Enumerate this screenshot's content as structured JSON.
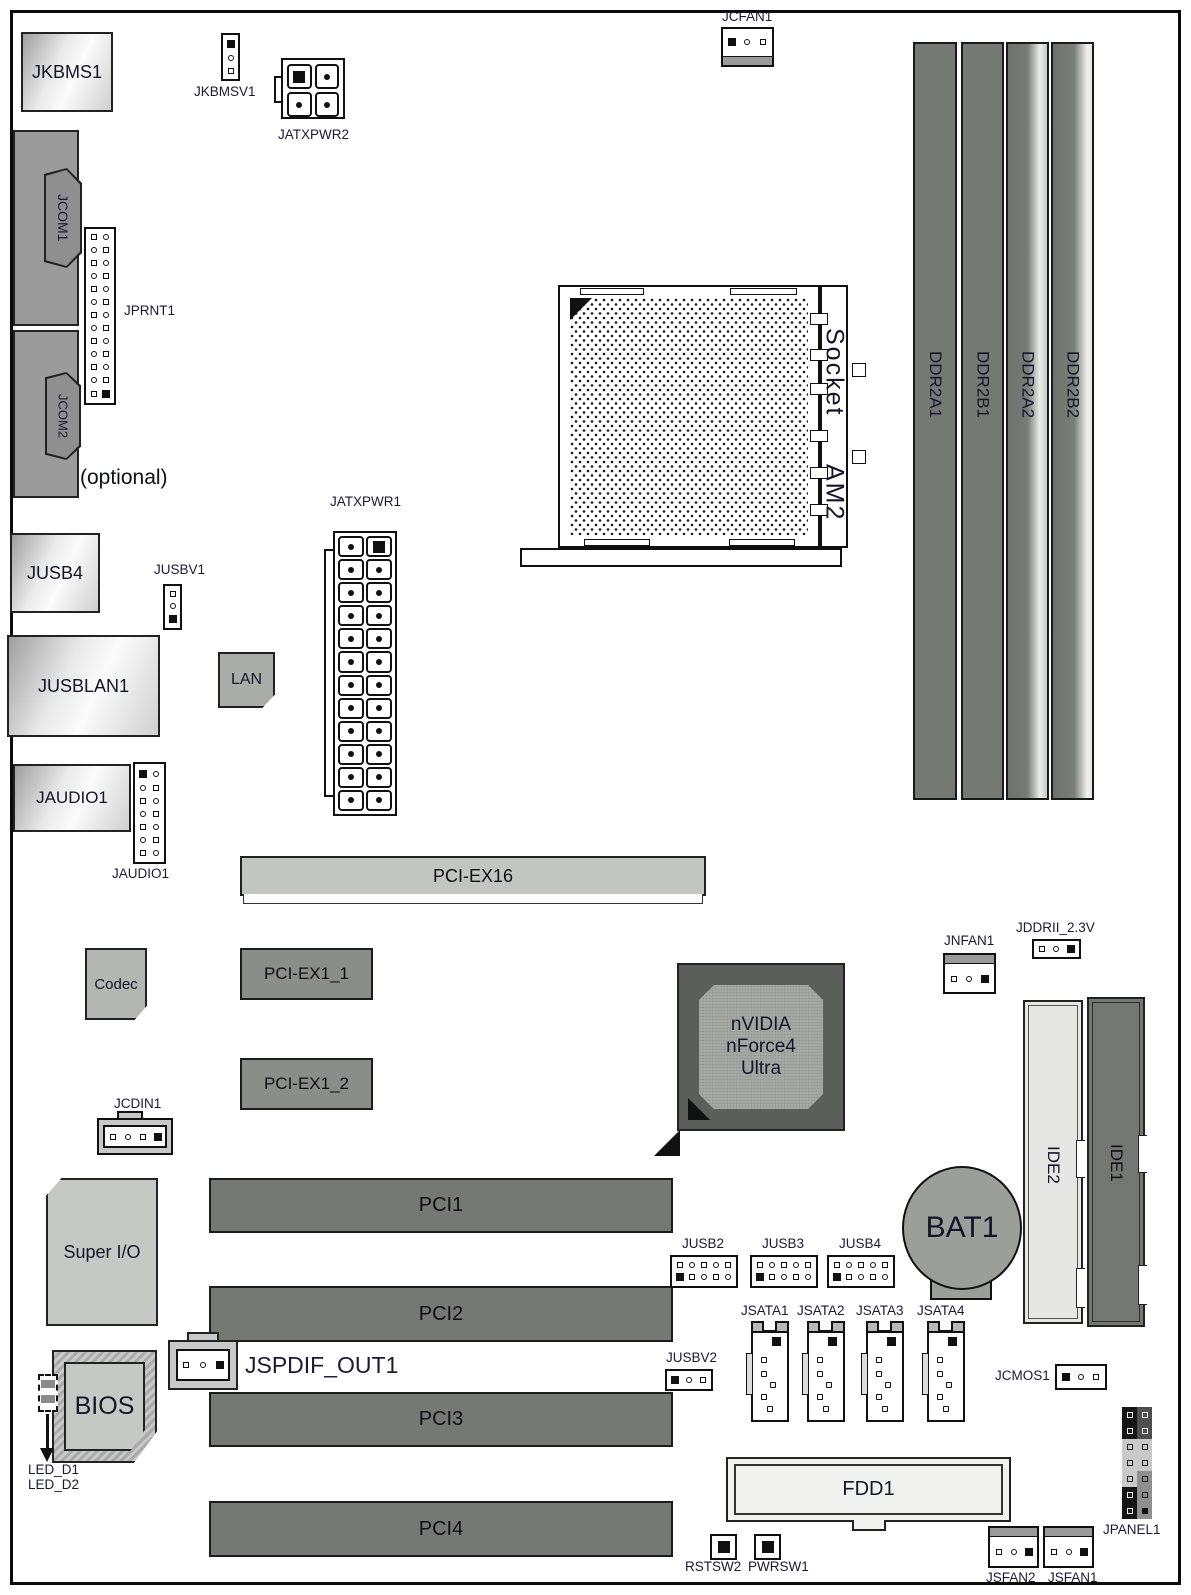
{
  "palette": {
    "outline": "#111111",
    "slot_dark": "#767973",
    "slot_mid": "#8a8d88",
    "slot_light": "#c2c5c0",
    "chip_dark": "#5b5e59",
    "chip_inner": "#a6a9a4",
    "ide_light": "#e6e6e4",
    "label_text": "#1a1a33"
  },
  "connectors": {
    "jkbms1": "JKBMS1",
    "jkbmsv1": "JKBMSV1",
    "jatxpwr2": "JATXPWR2",
    "jcfan1": "JCFAN1",
    "jcom1": "JCOM1",
    "jprnt1": "JPRNT1",
    "jcom2": "JCOM2",
    "optional": "(optional)",
    "jusb4_port": "JUSB4",
    "jusbv1": "JUSBV1",
    "jusblan1": "JUSBLAN1",
    "lan": "LAN",
    "jatxpwr1": "JATXPWR1",
    "jaudio1_port": "JAUDIO1",
    "jaudio1_header": "JAUDIO1",
    "socket_line1": "Socket",
    "socket_line2": "AM2",
    "ddr": [
      "DDR2A1",
      "DDR2B1",
      "DDR2A2",
      "DDR2B2"
    ],
    "pciex16": "PCI-EX16",
    "codec": "Codec",
    "pciex1_1": "PCI-EX1_1",
    "pciex1_2": "PCI-EX1_2",
    "jcdin1": "JCDIN1",
    "superio": "Super I/O",
    "nvidia_line1": "nVIDIA",
    "nvidia_line2": "nForce4",
    "nvidia_line3": "Ultra",
    "jnfan1": "JNFAN1",
    "jddrii": "JDDRII_2.3V",
    "ide2": "IDE2",
    "ide1": "IDE1",
    "bat1": "BAT1",
    "pci": [
      "PCI1",
      "PCI2",
      "PCI3",
      "PCI4"
    ],
    "jusb2": "JUSB2",
    "jusb3": "JUSB3",
    "jusb4_header": "JUSB4",
    "jsata": [
      "JSATA1",
      "JSATA2",
      "JSATA3",
      "JSATA4"
    ],
    "jusbv2": "JUSBV2",
    "jcmos1": "JCMOS1",
    "jspdif_out1": "JSPDIF_OUT1",
    "bios": "BIOS",
    "led_d1": "LED_D1",
    "led_d2": "LED_D2",
    "fdd1": "FDD1",
    "rstsw2": "RSTSW2",
    "pwrsw1": "PWRSW1",
    "jsfan2": "JSFAN2",
    "jsfan1": "JSFAN1",
    "jpanel1": "JPANEL1"
  }
}
